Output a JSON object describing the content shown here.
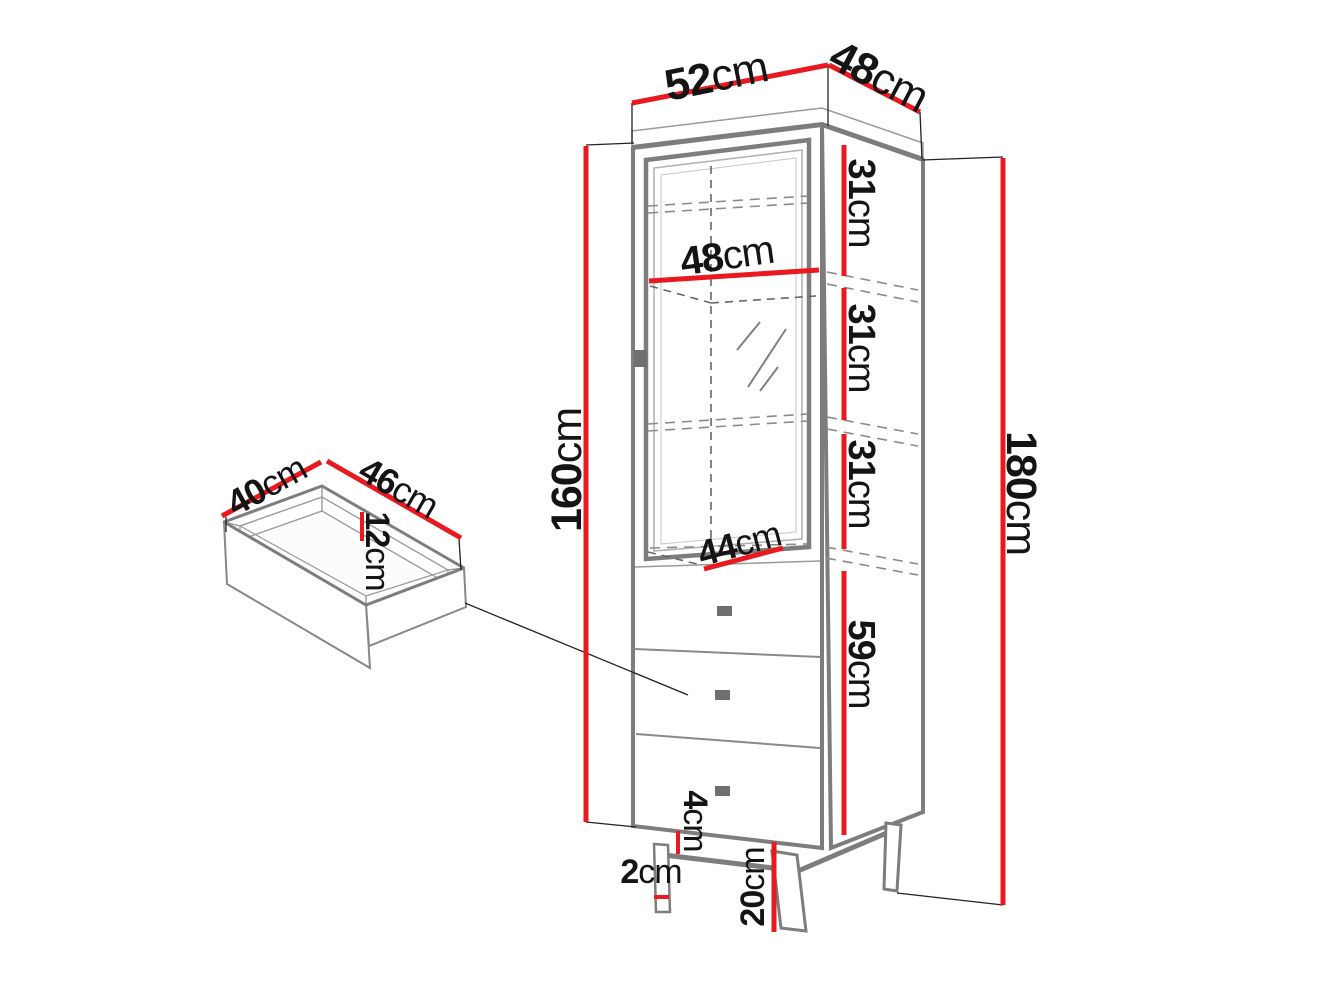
{
  "colors": {
    "dimension": "#e8191f",
    "outline": "#7d7d7d",
    "thin_line": "#222222",
    "handle": "#6f6f6f",
    "text": "#141414"
  },
  "dimensions": {
    "top_width": {
      "num": "52",
      "unit": "cm"
    },
    "top_depth": {
      "num": "48",
      "unit": "cm"
    },
    "shelf_section_1": {
      "num": "31",
      "unit": "cm"
    },
    "shelf_section_2": {
      "num": "31",
      "unit": "cm"
    },
    "shelf_section_3": {
      "num": "31",
      "unit": "cm"
    },
    "drawer_section": {
      "num": "59",
      "unit": "cm"
    },
    "interior_width": {
      "num": "48",
      "unit": "cm"
    },
    "interior_lower_width": {
      "num": "44",
      "unit": "cm"
    },
    "body_height": {
      "num": "160",
      "unit": "cm"
    },
    "total_height": {
      "num": "180",
      "unit": "cm"
    },
    "drawer_depth": {
      "num": "40",
      "unit": "cm"
    },
    "drawer_width": {
      "num": "46",
      "unit": "cm"
    },
    "drawer_height": {
      "num": "12",
      "unit": "cm"
    },
    "apron_height": {
      "num": "4",
      "unit": "cm"
    },
    "leg_width": {
      "num": "2",
      "unit": "cm"
    },
    "leg_height": {
      "num": "20",
      "unit": "cm"
    }
  }
}
